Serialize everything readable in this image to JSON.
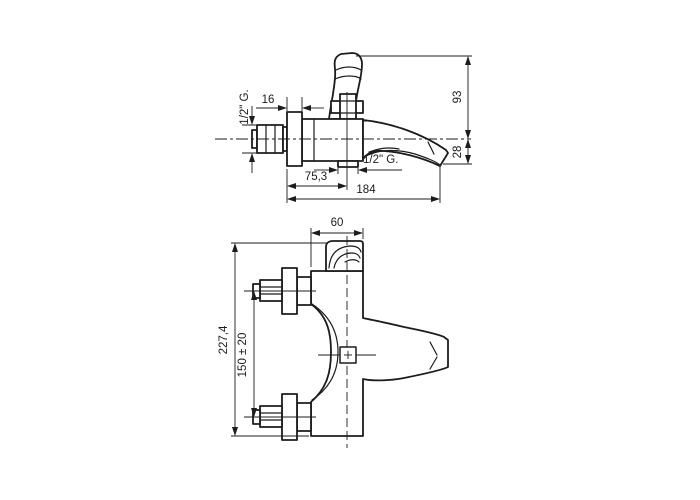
{
  "colors": {
    "background": "#ffffff",
    "line": "#1c1c1c"
  },
  "side_view": {
    "dim_flange_depth": "16",
    "dim_inlet_thread": "1/2\" G.",
    "dim_height_above_spout": "93",
    "dim_spout_drop": "28",
    "dim_flange_to_axis": "75,3",
    "dim_total_reach": "184",
    "dim_bottom_outlet_thread": "1/2\" G."
  },
  "plan_view": {
    "dim_body_width": "60",
    "dim_total_length": "227,4",
    "dim_connection_centres": "150 ± 20"
  }
}
